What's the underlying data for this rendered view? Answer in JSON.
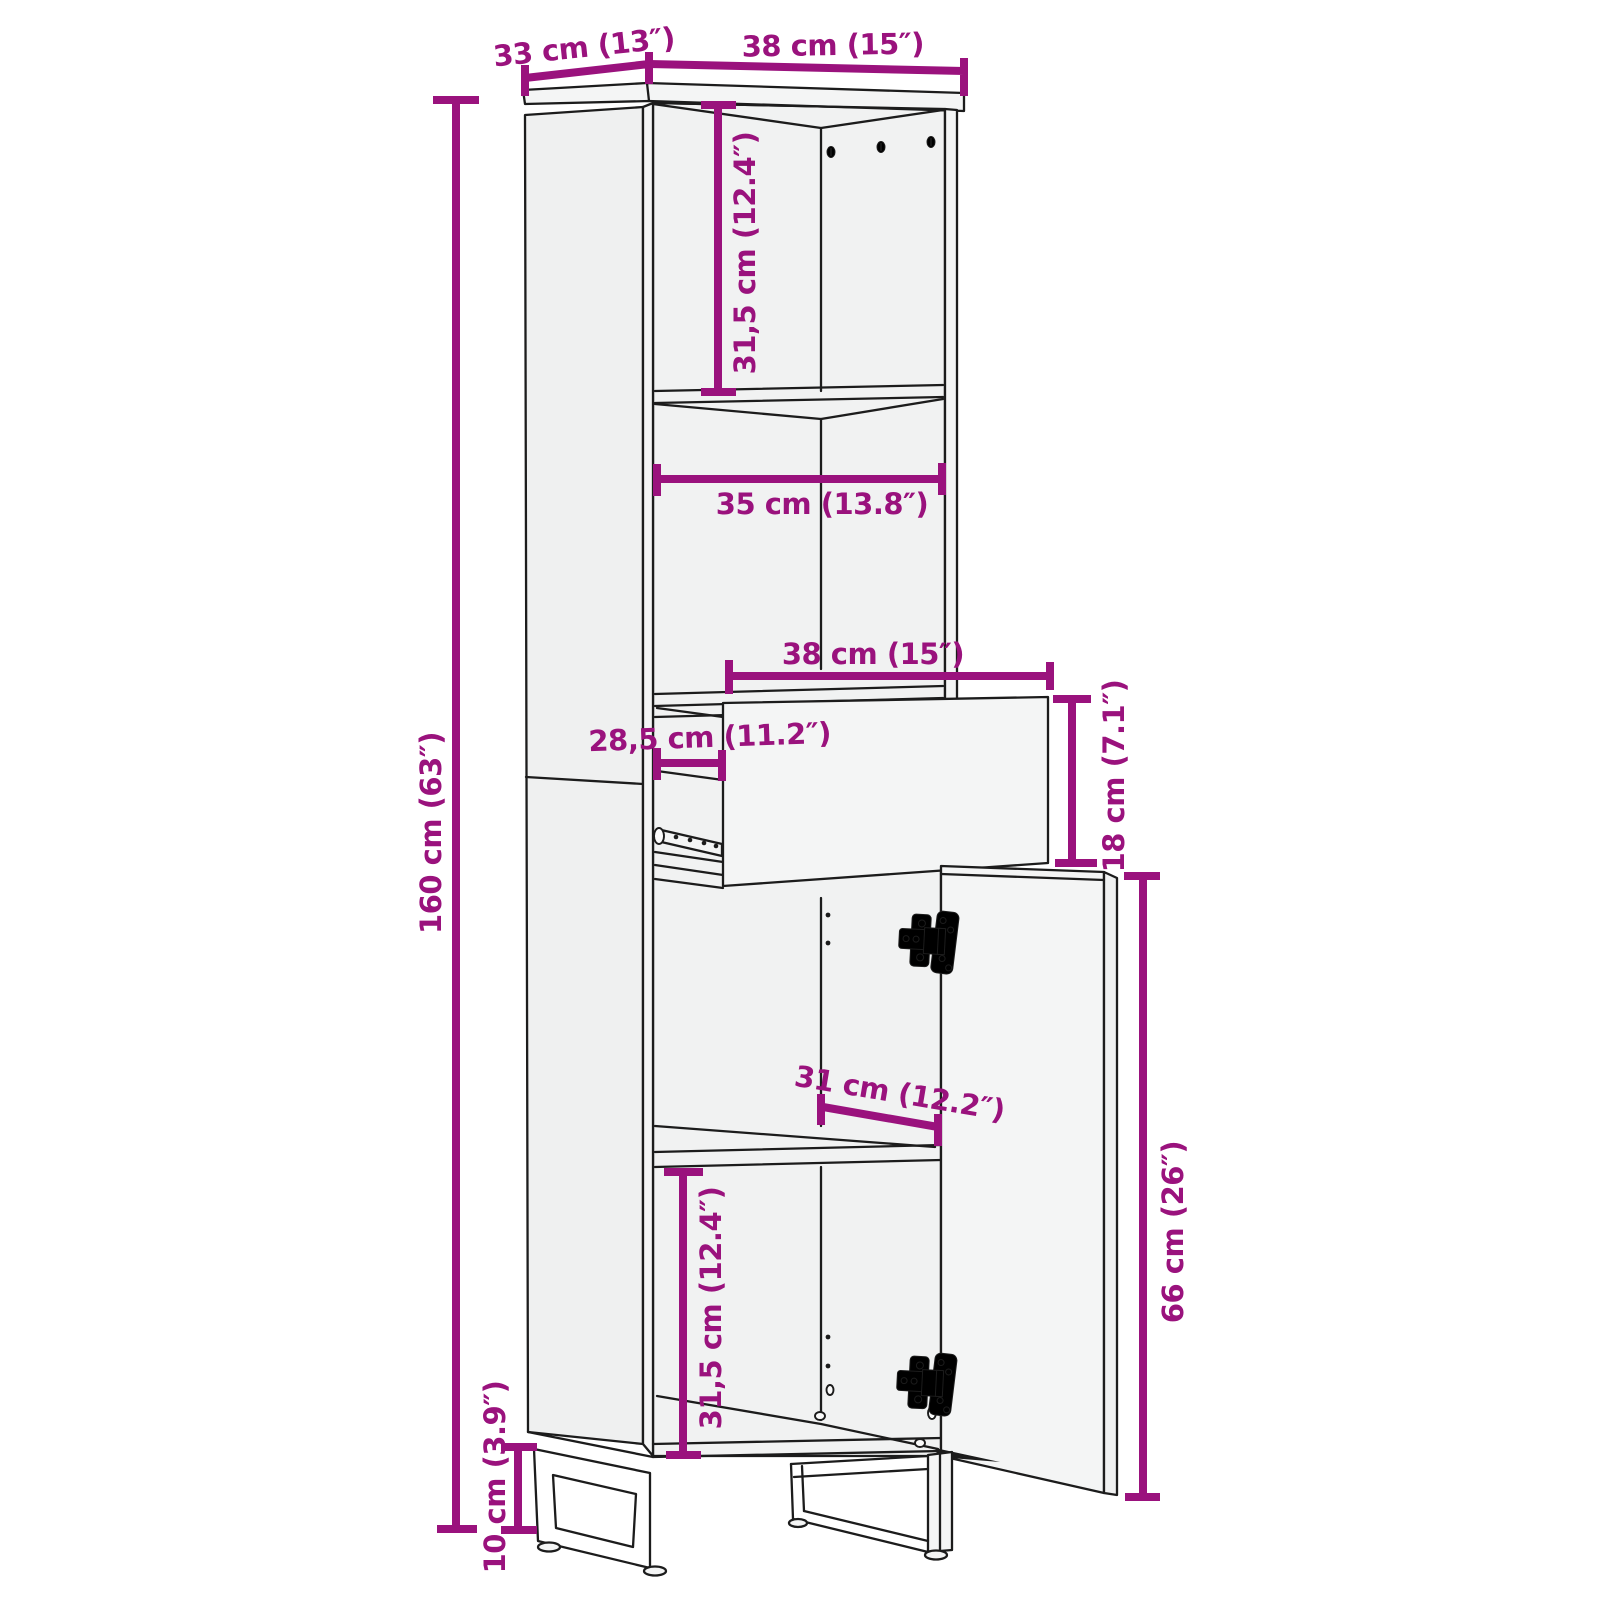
{
  "diagram": {
    "type": "furniture-dimension-drawing",
    "subject": "tall-bathroom-cabinet-with-drawer-and-door",
    "colors": {
      "dimension": "#9A127D",
      "outline": "#1C1C1C",
      "panel": "#F1F2F2",
      "background": "#FFFFFF"
    },
    "dimensions": [
      {
        "id": "top-depth",
        "label": "33 cm (13″)"
      },
      {
        "id": "top-width",
        "label": "38 cm (15″)"
      },
      {
        "id": "upper-compartment-height",
        "label": "31,5 cm (12.4″)"
      },
      {
        "id": "shelf-width",
        "label": "35 cm (13.8″)"
      },
      {
        "id": "drawer-width",
        "label": "38 cm (15″)"
      },
      {
        "id": "drawer-inner-depth",
        "label": "28,5 cm (11.2″)"
      },
      {
        "id": "drawer-height",
        "label": "18 cm (7.1″)"
      },
      {
        "id": "total-height",
        "label": "160 cm (63″)"
      },
      {
        "id": "door-opening-width",
        "label": "31 cm (12.2″)"
      },
      {
        "id": "lower-compartment-height",
        "label": "31,5 cm (12.4″)"
      },
      {
        "id": "door-height",
        "label": "66 cm (26″)"
      },
      {
        "id": "leg-height",
        "label": "10 cm (3.9″)"
      }
    ]
  }
}
